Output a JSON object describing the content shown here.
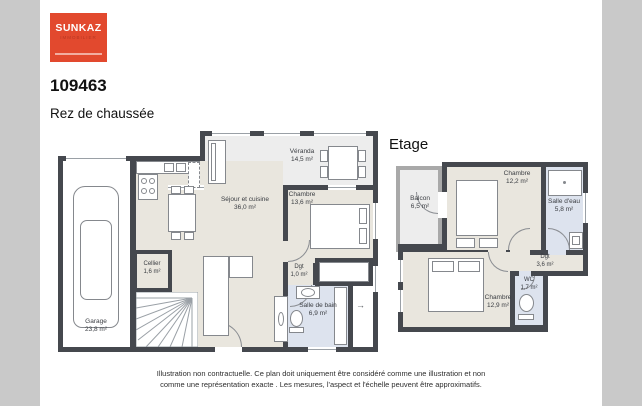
{
  "logo": {
    "brand": "SUNKAZ",
    "subtitle": "IMMOBILIER",
    "bg_color": "#e2492e"
  },
  "header": {
    "reference": "109463",
    "ground_floor_title": "Rez de chaussée",
    "upper_floor_title": "Etage"
  },
  "ground_floor": {
    "rooms": [
      {
        "name": "Véranda",
        "area": "14,5 m²"
      },
      {
        "name": "Séjour et cuisine",
        "area": "36,0 m²"
      },
      {
        "name": "Chambre",
        "area": "13,6 m²"
      },
      {
        "name": "Cellier",
        "area": "1,6 m²"
      },
      {
        "name": "Garage",
        "area": "23,8 m²"
      },
      {
        "name": "Dgt",
        "area": "1,0 m²"
      },
      {
        "name": "Salle de bain",
        "area": "6,9 m²"
      }
    ],
    "entry_arrow": "→"
  },
  "upper_floor": {
    "rooms": [
      {
        "name": "Balcon",
        "area": "6,5 m²"
      },
      {
        "name": "Chambre",
        "area": "12,2 m²"
      },
      {
        "name": "Salle d'eau",
        "area": "5,8 m²"
      },
      {
        "name": "Dgt",
        "area": "3,6 m²"
      },
      {
        "name": "WC",
        "area": "1,7 m²"
      },
      {
        "name": "Chambre",
        "area": "12,9 m²"
      }
    ]
  },
  "footer": {
    "line1": "Illustration non contractuelle. Ce plan doit uniquement être considéré comme une illustration et non",
    "line2": "comme une représentation exacte . Les mesures, l'aspect et l'échelle peuvent être approximatifs."
  },
  "colors": {
    "wall": "#45484e",
    "balcony_wall": "#a9a9a9",
    "floor_interior": "#e9e6de",
    "floor_outdoor": "#ededed",
    "floor_wet": "#dde3ee",
    "page_background": "#c9c9c9"
  }
}
